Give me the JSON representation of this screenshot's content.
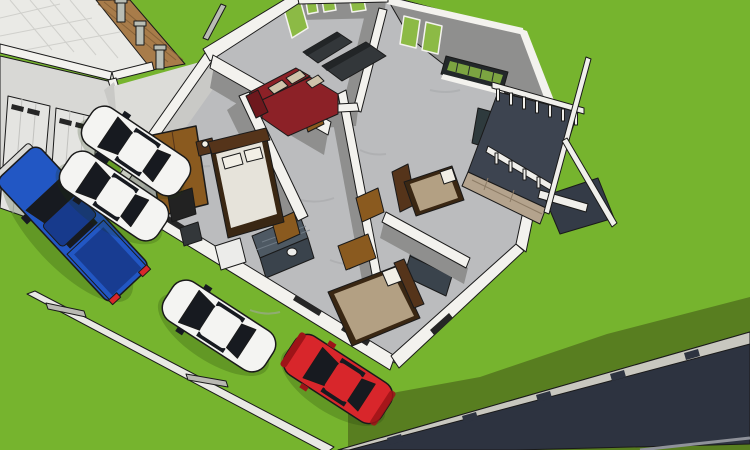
{
  "scene": {
    "kind": "3d-architectural-cutaway-render",
    "description": "Aerial dollhouse view of a one-story house model with cut walls showing furnished rooms, a garage, five parked vehicles on a green lawn, a wooden fence, a rear deck with stairs, and a roadside guardrail."
  },
  "palette": {
    "outline": "#1a1a1a",
    "grass": "#76b42e",
    "grassShadow": "#587e20",
    "road": "#2d3340",
    "roadRail": "#c8c7bf",
    "roadEdge": "#8f929a",
    "curb": "#e9e9e4",
    "curbTick": "#b9b9b2",
    "tile": "#eaeae6",
    "tileLine": "#d0d0cc",
    "fence": "#a87c4a",
    "fenceLine": "#7c5a33",
    "post": "#b9bdb4",
    "gate": "#2e312e",
    "gateLine": "#5a5d5a",
    "garage": "#d8d8d5",
    "door": "#e4e4e1",
    "doorLine": "#c2c2bf",
    "wallWhite": "#f3f2ee",
    "wallGray": "#8f8f8e",
    "wallLight": "#c9c9c6",
    "floor": "#bbbcbe",
    "streak": "#a6a7aa",
    "porch": "#dcdcd8",
    "slit": "#262626",
    "glass": "#8cba45",
    "grille": "#23282a",
    "bath": "#4e5963",
    "bathDark": "#3a434c",
    "bathLine": "#76818c",
    "wood": "#8a5a1f",
    "woodDark": "#55341a",
    "bedFrame": "#3a2713",
    "bedWhite": "#e6e3da",
    "pillow": "#f2efe6",
    "bedTan": "#b3a083",
    "sofaRed": "#8c2127",
    "sofaRedDark": "#6e181d",
    "cushion": "#cfc3ab",
    "sofaDark": "#33373a",
    "sofaDarkTop": "#222527",
    "counter": "#2e3a3d",
    "deck": "#3d4450",
    "deckDark": "#343b47",
    "stone": "#b4a38d",
    "stoneLine": "#8d7c66",
    "rail": "#f0efeb",
    "truckBlue": "#2257c4",
    "truckBlueDark": "#173a8c",
    "bumper": "#d9d9d6",
    "carWhite": "#f4f4f2",
    "carWhiteShade": "#d8d8d3",
    "carRed": "#d8262b",
    "carRedDark": "#9e1418",
    "glassCar": "#171a20",
    "appliance": "#ececea",
    "objDark": "#222222",
    "shadow": "#1c3508"
  },
  "objects": [
    "lawn",
    "terrain-shadow",
    "asphalt-road",
    "roadside-guardrail",
    "property-curb",
    "tiled-patio",
    "wooden-fence",
    "fence-posts",
    "garage-building",
    "garage-doors",
    "metal-gate",
    "cutaway-house",
    "master-bedroom",
    "wardrobe",
    "double-bed",
    "living-room",
    "red-sectional-sofa",
    "tv-lounge",
    "dark-sofa-set",
    "hallway",
    "tiled-bathrooms",
    "guest-bedroom",
    "rear-bedroom",
    "kitchen-great-room",
    "window-grille",
    "rear-deck",
    "deck-railing",
    "stair-stringers",
    "blue-pickup-truck",
    "white-sedan-1",
    "white-sedan-2",
    "white-sedan-3",
    "red-hatchback"
  ]
}
